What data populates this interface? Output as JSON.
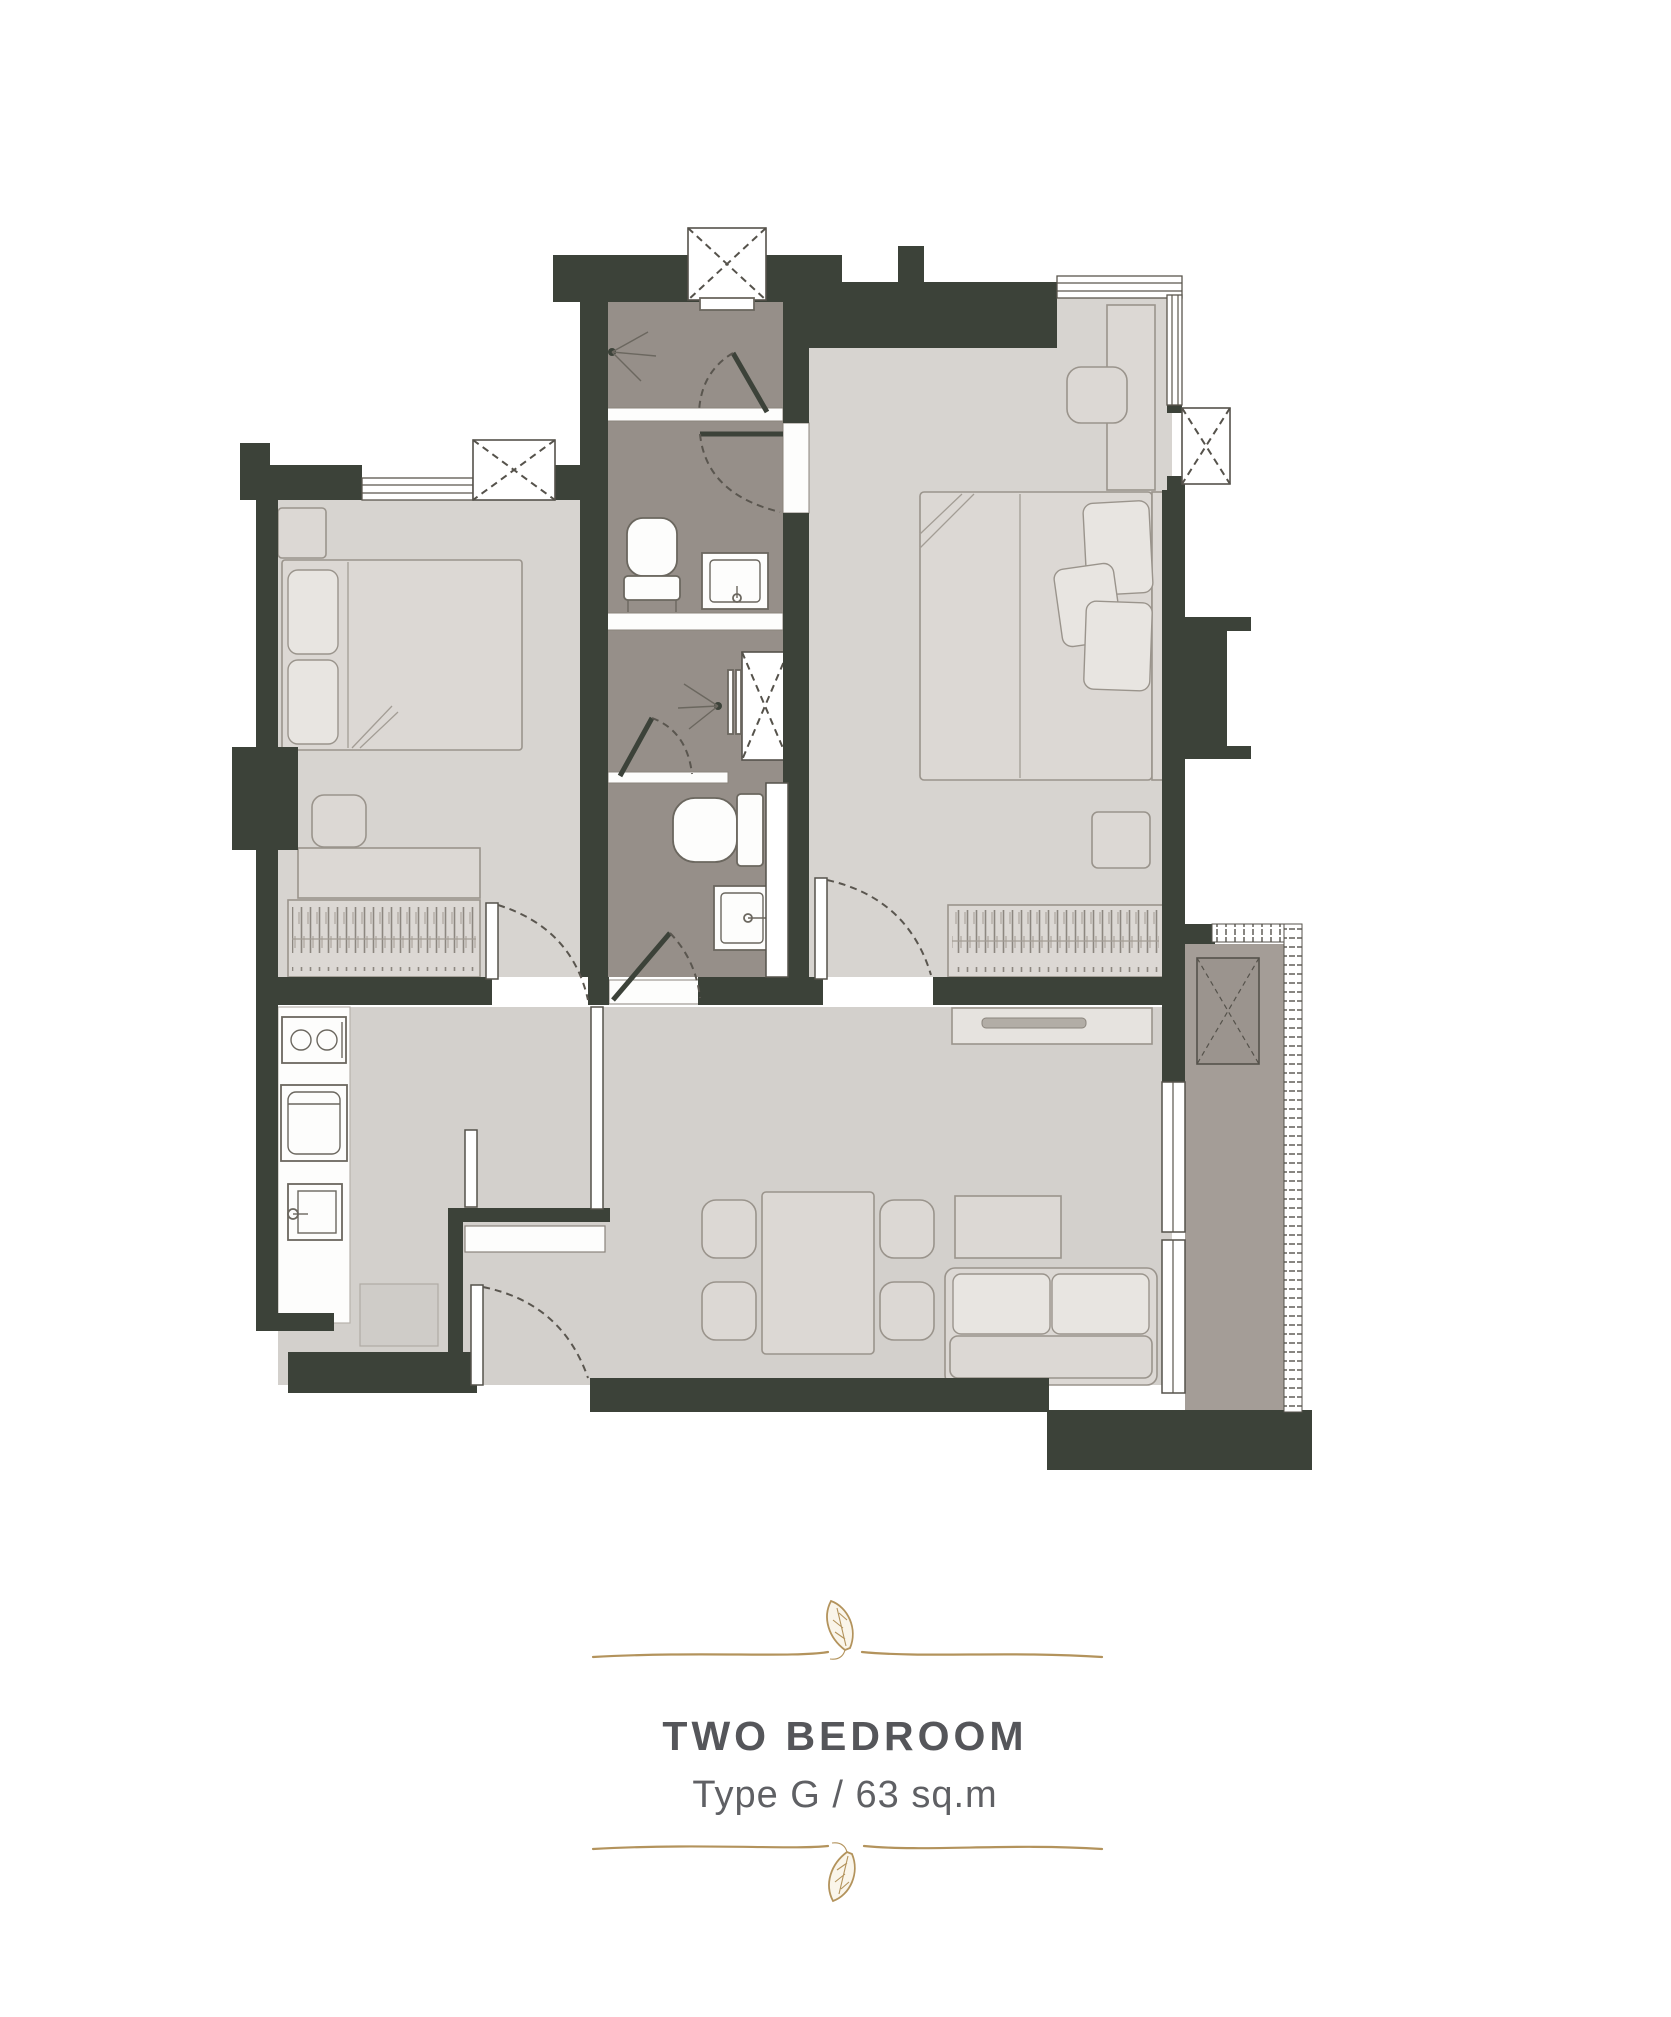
{
  "title_block": {
    "title": "TWO BEDROOM",
    "subtitle": "Type G / 63 sq.m"
  },
  "plan": {
    "unit_type": "Type G",
    "area_label": "63 sq.m",
    "rooms_depicted": [
      "Master Bedroom",
      "Second Bedroom",
      "Master Bathroom",
      "Second Bathroom",
      "Kitchen",
      "Living / Dining",
      "Entrance",
      "Balcony"
    ]
  },
  "colors": {
    "wall": "#3c4239",
    "room_floor": "#d7d4d0",
    "living_floor": "#d3d0cc",
    "bathroom_floor": "#968f89",
    "balcony_floor": "#a49d97",
    "fixture_white": "#fdfdfc",
    "furniture_fill": "#dcd8d4",
    "furniture_stroke": "#9a948c",
    "ornament_gold": "#b3935c",
    "title_text": "#55565a",
    "subtitle_text": "#5f6064"
  }
}
